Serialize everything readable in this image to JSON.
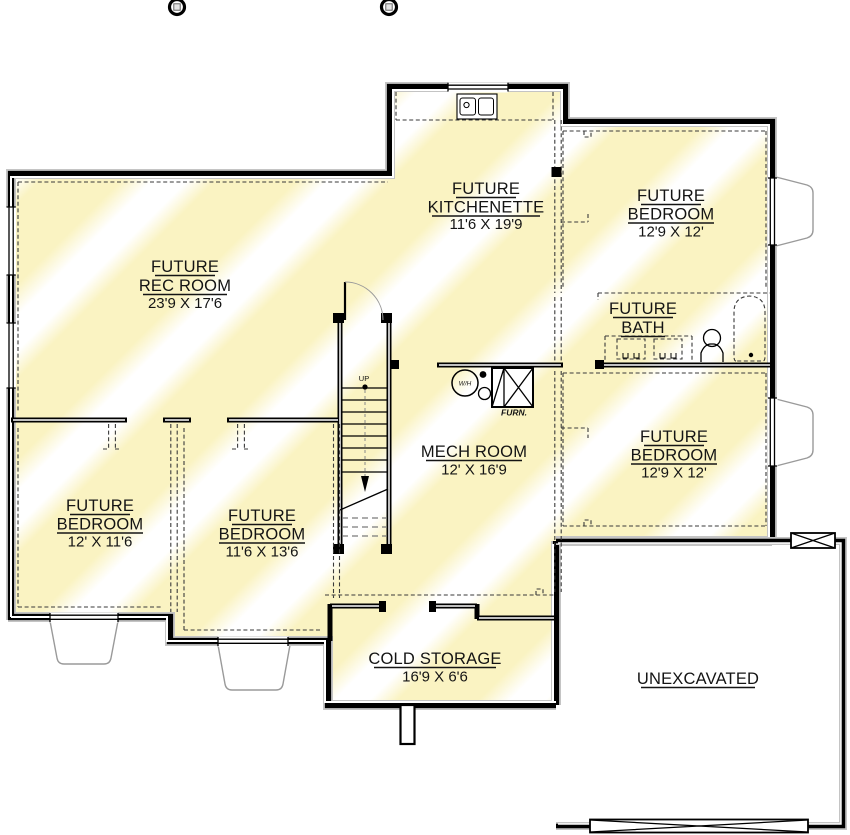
{
  "plan": {
    "rooms": {
      "rec_room": {
        "line1": "FUTURE",
        "line2": "REC ROOM",
        "dims": "23'9 X 17'6"
      },
      "kitchenette": {
        "line1": "FUTURE",
        "line2": "KITCHENETTE",
        "dims": "11'6 X 19'9"
      },
      "bedroom_top_right": {
        "line1": "FUTURE",
        "line2": "BEDROOM",
        "dims": "12'9 X 12'"
      },
      "bath": {
        "line1": "FUTURE",
        "line2": "BATH"
      },
      "bedroom_right": {
        "line1": "FUTURE",
        "line2": "BEDROOM",
        "dims": "12'9 X 12'"
      },
      "mech_room": {
        "line1": "MECH ROOM",
        "dims": "12' X 16'9"
      },
      "bedroom_left": {
        "line1": "FUTURE",
        "line2": "BEDROOM",
        "dims": "12' X 11'6"
      },
      "bedroom_mid": {
        "line1": "FUTURE",
        "line2": "BEDROOM",
        "dims": "11'6 X 13'6"
      },
      "cold_storage": {
        "line1": "COLD STORAGE",
        "dims": "16'9 X 6'6"
      },
      "unexcavated": {
        "line1": "UNEXCAVATED"
      }
    },
    "fixtures": {
      "stairs_direction": "UP",
      "water_heater": "W/H",
      "furnace": "FURN."
    },
    "colors": {
      "stripe_yellow": "#faf3c2",
      "wall": "#000000",
      "well_gray": "#9a9a9a"
    }
  }
}
